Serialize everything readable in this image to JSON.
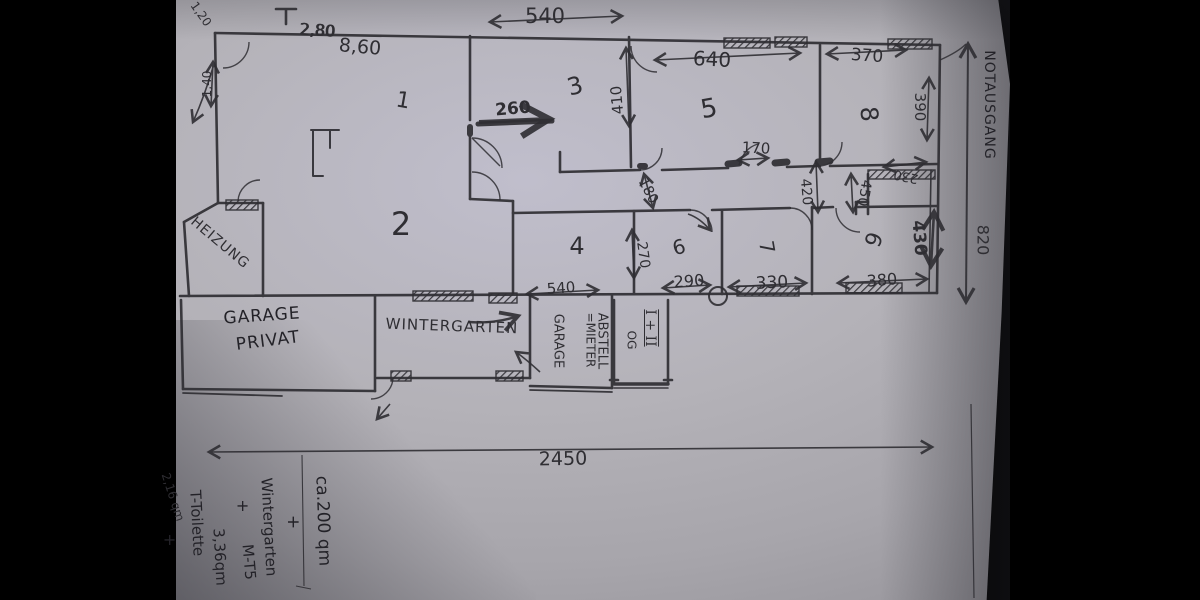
{
  "dims": {
    "w120": "1,20",
    "w140": "1,40",
    "w280": "2,80",
    "w860": "8,60",
    "top540": "540",
    "d640": "640",
    "d370": "370",
    "d390": "390",
    "d410": "410",
    "d260": "260",
    "d170": "170",
    "d180": "180",
    "d420": "420",
    "d230": "230",
    "d450": "450",
    "d430": "430",
    "d270": "270",
    "d290": "290",
    "d330": "330",
    "d380": "380",
    "bottom540": "540",
    "total_width": "2450",
    "total_height": "820"
  },
  "rooms": {
    "r1": "1",
    "r2": "2",
    "r3": "3",
    "r4": "4",
    "r5": "5",
    "r6": "6",
    "r7": "7",
    "r8": "8",
    "r9": "9"
  },
  "labels": {
    "notausgang": "NOTAUSGANG",
    "heizung": "HEIZUNG",
    "garage_line1": "GARAGE",
    "garage_line2": "PRIVAT",
    "wintergarten": "WINTERGARTEN",
    "abstell_line1": "ABSTELL",
    "abstell_line2": "GARAGE",
    "og_line1": "OG",
    "og_line2": "=MIETER",
    "floors": "I + II"
  },
  "notes": {
    "area_total": "ca.200 qm",
    "plus": "+",
    "wintergarten": "Wintergarten",
    "mt": "M-T5",
    "toilette": "T-Toilette",
    "toilette_area": "3,36qm",
    "small_area": "2,16 qm"
  },
  "colors": {
    "background": "#000000",
    "paper": "#b4b2b8",
    "ink": "#2f2e33"
  }
}
